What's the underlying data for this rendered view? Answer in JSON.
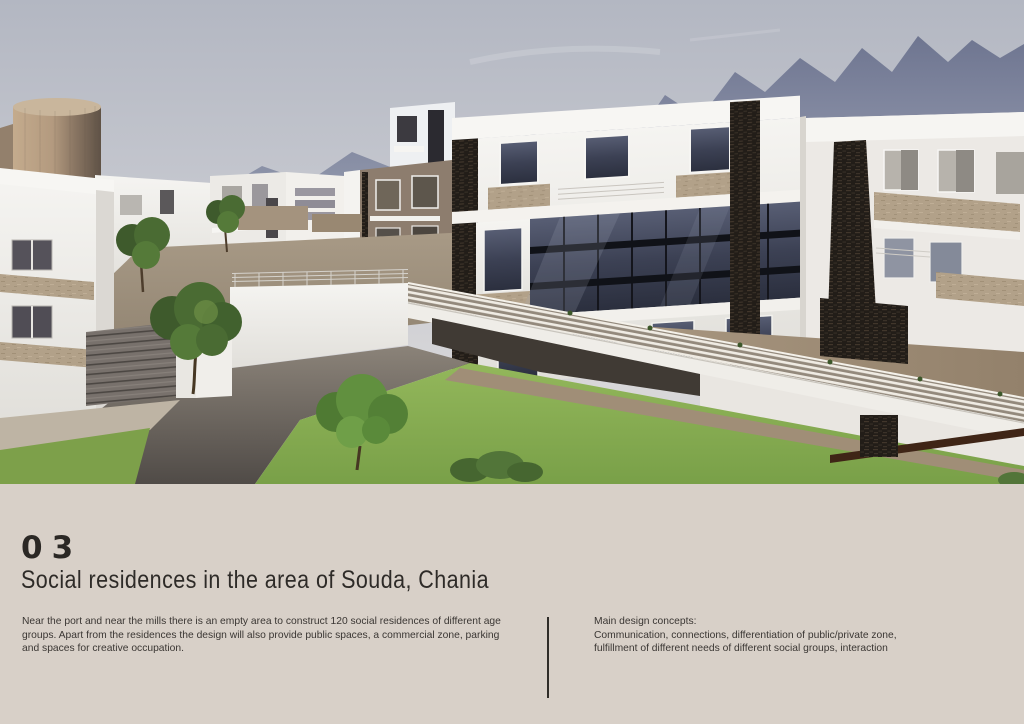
{
  "panel": {
    "section_number": "03",
    "title": "Social residences in the area of Souda, Chania",
    "description": "Near the port and near the mills there is an empty area to construct 120 social residences of different age\ngroups. Apart from the residences the design will also provide public spaces, a commercial zone, parking\nand spaces for creative occupation.",
    "concepts": "Main design concepts:\nCommunication, connections, differentiation of public/private zone,\nfulfillment of different needs of different social groups, interaction"
  },
  "render": {
    "description": "3D architectural rendering of white modern social housing blocks with dark stacked-stone accents, glass curtain walls, tan balcony slabs, an elevated walkway bridge with railings, a cylindrical tan tower, paved plaza with stairs, green lawns and trees, and hazy mountains in the background",
    "colors": {
      "sky_top": "#b3b7c2",
      "sky_bottom": "#d8d7d9",
      "mountains": "#7b8299",
      "building_white": "#f2f1ee",
      "glass": "#3f4456",
      "stone_dark": "#241f1a",
      "stone_tan": "#b2a189",
      "lawn": "#86ad52",
      "plaza": "#5f5a55",
      "panel_background": "#d8d0c8",
      "text": "#35312e",
      "divider": "#2f2c28"
    }
  }
}
